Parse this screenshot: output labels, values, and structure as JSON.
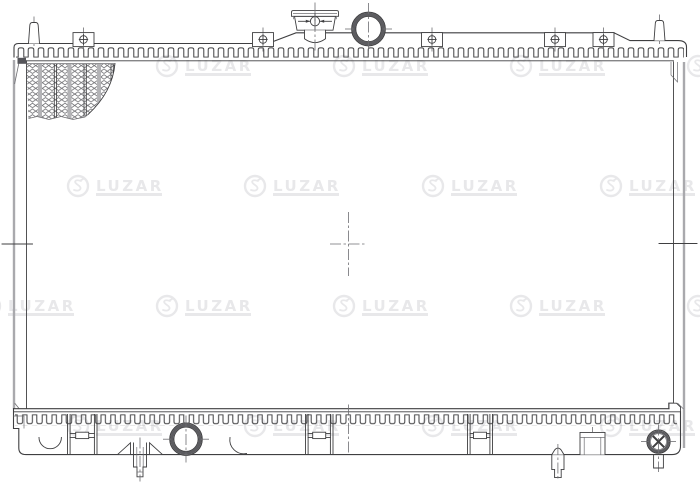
{
  "watermark": {
    "label": "LUZAR",
    "positions": [
      {
        "x": 155,
        "y": 66
      },
      {
        "x": 332,
        "y": 66
      },
      {
        "x": 509,
        "y": 66
      },
      {
        "x": 686,
        "y": 66
      },
      {
        "x": 66,
        "y": 186
      },
      {
        "x": 243,
        "y": 186
      },
      {
        "x": 421,
        "y": 186
      },
      {
        "x": 599,
        "y": 186
      },
      {
        "x": -22,
        "y": 306
      },
      {
        "x": 155,
        "y": 306
      },
      {
        "x": 332,
        "y": 306
      },
      {
        "x": 509,
        "y": 306
      },
      {
        "x": 686,
        "y": 306
      },
      {
        "x": 66,
        "y": 426
      },
      {
        "x": 243,
        "y": 426
      },
      {
        "x": 421,
        "y": 426
      },
      {
        "x": 599,
        "y": 426
      }
    ]
  },
  "colors": {
    "ink": "#3f3f41",
    "mid_gray": "#6e6e72",
    "light_gray": "#a9a9ad",
    "watermark": "#e8e8ea",
    "background": "#ffffff"
  }
}
